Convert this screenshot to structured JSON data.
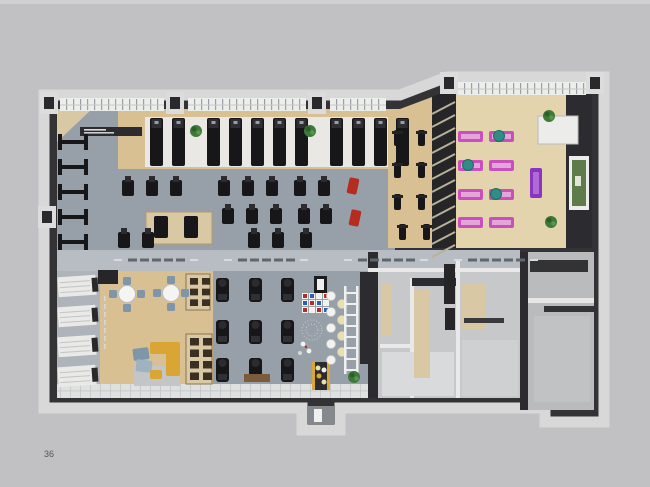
{
  "page": {
    "number": "36"
  },
  "plan": {
    "name": "fitness-club-3d-floor-plan",
    "rooms": [
      {
        "id": "cardio-strength-gym",
        "floor": "carpet"
      },
      {
        "id": "treadmill-row",
        "floor": "platform"
      },
      {
        "id": "spin-bike-zone",
        "floor": "wood"
      },
      {
        "id": "yoga-studio",
        "floor": "woodLight"
      },
      {
        "id": "lounge-cafe",
        "floor": "wood"
      },
      {
        "id": "cardio-machines-row",
        "floor": "carpet"
      },
      {
        "id": "kids-play-zone",
        "floor": "carpet"
      },
      {
        "id": "locker-shelf-wall",
        "floor": "gray"
      },
      {
        "id": "changing-rooms",
        "floor": "grayRoom"
      },
      {
        "id": "utility-rooms",
        "floor": "grayRoom2"
      },
      {
        "id": "walkway-corridor",
        "floor": "walkway"
      },
      {
        "id": "entrance-vestibule",
        "floor": "dark"
      }
    ],
    "inventory": {
      "treadmill_groups": [
        2,
        5,
        4
      ],
      "wall_stations": 5,
      "strength_rows": [
        8,
        5,
        5
      ],
      "platform_machines": 2,
      "red_benches": 2,
      "spin_bikes": 8,
      "yoga_mats": 8,
      "exercise_balls": 3,
      "purple_mats": 1,
      "cafe_tables": 2,
      "chairs_per_table": 4,
      "cardio_machines": 9,
      "locker_shelves": 4,
      "plants": 5,
      "ladder_rungs": 8,
      "wall_circle_colors": [
        "w",
        "y",
        "w",
        "y",
        "w",
        "y",
        "w",
        "y",
        "w"
      ],
      "climb_grid": [
        [
          "r",
          "b",
          "w",
          "r"
        ],
        [
          "b",
          "r",
          "b",
          "w"
        ],
        [
          "r",
          "w",
          "r",
          "b"
        ]
      ],
      "corridor_dash_groups": 4
    }
  },
  "palette": {
    "bg": "#c1c1c3",
    "bgTop": "#d0d0d2",
    "trim": "#d8d8d8",
    "wall": "#333335",
    "wallDark": "#262628",
    "carpet": "#97a0a8",
    "walkway": "#b7bdc2",
    "grayZone": "#aeb4ba",
    "wood": "#d8c093",
    "woodLight": "#e4d4ae",
    "tan": "#d9c8a4",
    "platform": "#e9e8e5",
    "white": "#efefed",
    "grayRoom": "#c6c8c9",
    "grayRoom2": "#b9bbbd",
    "equipment": "#17171a",
    "equipment2": "#2c2c30",
    "red": "#b52c20",
    "pink": "#ca4fbe",
    "pinkLight": "#e3a5da",
    "purple": "#8a35c2",
    "teal": "#2f8c86",
    "yellow": "#d9a636",
    "blue": "#7e96a8",
    "green": "#3c7a38",
    "greenDark": "#2f5e2c",
    "frameGreen": "#5d7c49",
    "dash": "#5f666c",
    "text": "#55555a"
  }
}
